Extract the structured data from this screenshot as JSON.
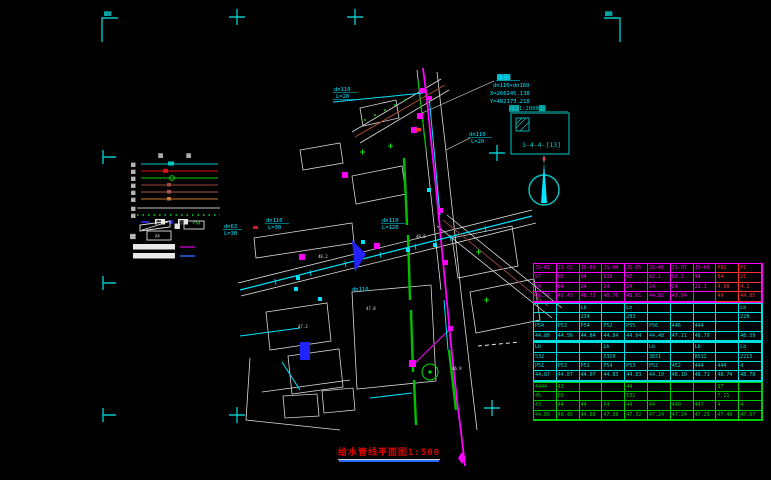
{
  "drawing": {
    "title_text": "给水管线平面图",
    "title_scale": "1:500",
    "corner_note": "▓▓▓"
  },
  "index_box": {
    "caption": "▓▓▓1:2000▓▓",
    "code": "3-4-4-[13]",
    "color": "#00c8c8"
  },
  "annotation": {
    "line1": "▓▓▓▓",
    "line2": "dn110×dn160",
    "line3": "X=266245.138",
    "line4": "Y=482173.218",
    "color": "#00e5ff"
  },
  "legend": {
    "header1": "▓▓",
    "header2": "▓▓",
    "lines": [
      {
        "label": "▓▓",
        "color": "#00c8c8"
      },
      {
        "label": "▓▓",
        "color": "#dd1111"
      },
      {
        "label": "▓▓",
        "color": "#00cc00"
      },
      {
        "label": "▓▓",
        "color": "#9a4a3a"
      },
      {
        "label": "▓▓",
        "color": "#a85848"
      },
      {
        "label": "▓▓",
        "color": "#c87830"
      },
      {
        "label": "▓▓",
        "color": "#bfbfbf"
      },
      {
        "label": "▓▓",
        "color": "#00aa22"
      }
    ],
    "box1_label": "▓▓",
    "box2_label": "▓▓",
    "frame_caption": "▓▓",
    "frame_label": "A4"
  },
  "map": {
    "pipe_labels": [
      {
        "t": "dn110"
      },
      {
        "t": "L=20"
      },
      {
        "t": "dn110"
      },
      {
        "t": "L=20"
      },
      {
        "t": "dn63"
      },
      {
        "t": "L=30"
      },
      {
        "t": "dn110"
      },
      {
        "t": "L=30"
      },
      {
        "t": "dn110"
      },
      {
        "t": "L=120"
      },
      {
        "t": "dn110"
      }
    ],
    "spot_elevations": [
      {
        "t": "48.2"
      },
      {
        "t": "47.8"
      },
      {
        "t": "47.3"
      },
      {
        "t": "48.6"
      },
      {
        "t": "46.9"
      }
    ]
  },
  "table": {
    "red_color": "#ff3030",
    "groups": [
      {
        "color": "#ff00ff",
        "red_cols": [
          8,
          9
        ],
        "rows": [
          [
            "JS-01",
            "JS-02",
            "JS-03",
            "JS-04",
            "JS-05",
            "JS-06",
            "JS-07",
            "JS-08",
            "P92",
            "P1"
          ],
          [
            "97",
            "95",
            "94",
            "919",
            "97",
            "92.1",
            "92.2",
            "94",
            "84",
            "21"
          ],
          [
            "24",
            "84",
            "24",
            "24",
            "24",
            "24",
            "24",
            "21.1",
            "4.98",
            "4.1"
          ],
          [
            "48.74",
            "48.43",
            "48.73",
            "48.76",
            "48.81",
            "44.82",
            "43.84",
            "",
            "49",
            "44.85"
          ]
        ]
      },
      {
        "color": "#00e0e0",
        "rows": [
          [
            "",
            "",
            "Lb",
            "",
            "Lb",
            "",
            "",
            "",
            "",
            "Lb"
          ],
          [
            "",
            "",
            "234",
            "",
            "283",
            "",
            "",
            "",
            "",
            "228"
          ],
          [
            "P54",
            "P53",
            "P54",
            "P52",
            "P55",
            "P56",
            "446",
            "444",
            "",
            ""
          ],
          [
            "44.86",
            "44.56",
            "44.84",
            "44.84",
            "44.94",
            "44.48",
            "47.11",
            "48.79",
            "",
            "48.39"
          ]
        ]
      },
      {
        "color": "#00e0e0",
        "rows": [
          [
            "Lb",
            "",
            "",
            "Lb",
            "",
            "Lb",
            "",
            "Lb",
            "",
            "Lb"
          ],
          [
            "532",
            "",
            "",
            "5310",
            "",
            "3871",
            "",
            "8512",
            "",
            "2213"
          ],
          [
            "P51",
            "P53",
            "P51",
            "P54",
            "P53",
            "P52",
            "452",
            "444",
            "444",
            "4"
          ],
          [
            "44.87",
            "44.87",
            "44.07",
            "44.83",
            "44.83",
            "44.10",
            "48.10",
            "48.71",
            "48.74",
            "48.78"
          ]
        ]
      },
      {
        "color": "#00cc00",
        "rows": [
          [
            "4444",
            "43",
            "",
            "",
            "44",
            "",
            "",
            "",
            "87",
            ""
          ],
          [
            "45",
            "D3",
            "",
            "",
            "532",
            "",
            "",
            "",
            "7.21",
            ""
          ],
          [
            "43",
            "44",
            "44",
            "P4",
            "44",
            "44",
            "440",
            "447",
            "4",
            "4"
          ],
          [
            "44.85",
            "48.45",
            "44.88",
            "47.28",
            "47.32",
            "47.24",
            "47.24",
            "47.29",
            "47.49",
            "47.87"
          ]
        ]
      }
    ]
  }
}
